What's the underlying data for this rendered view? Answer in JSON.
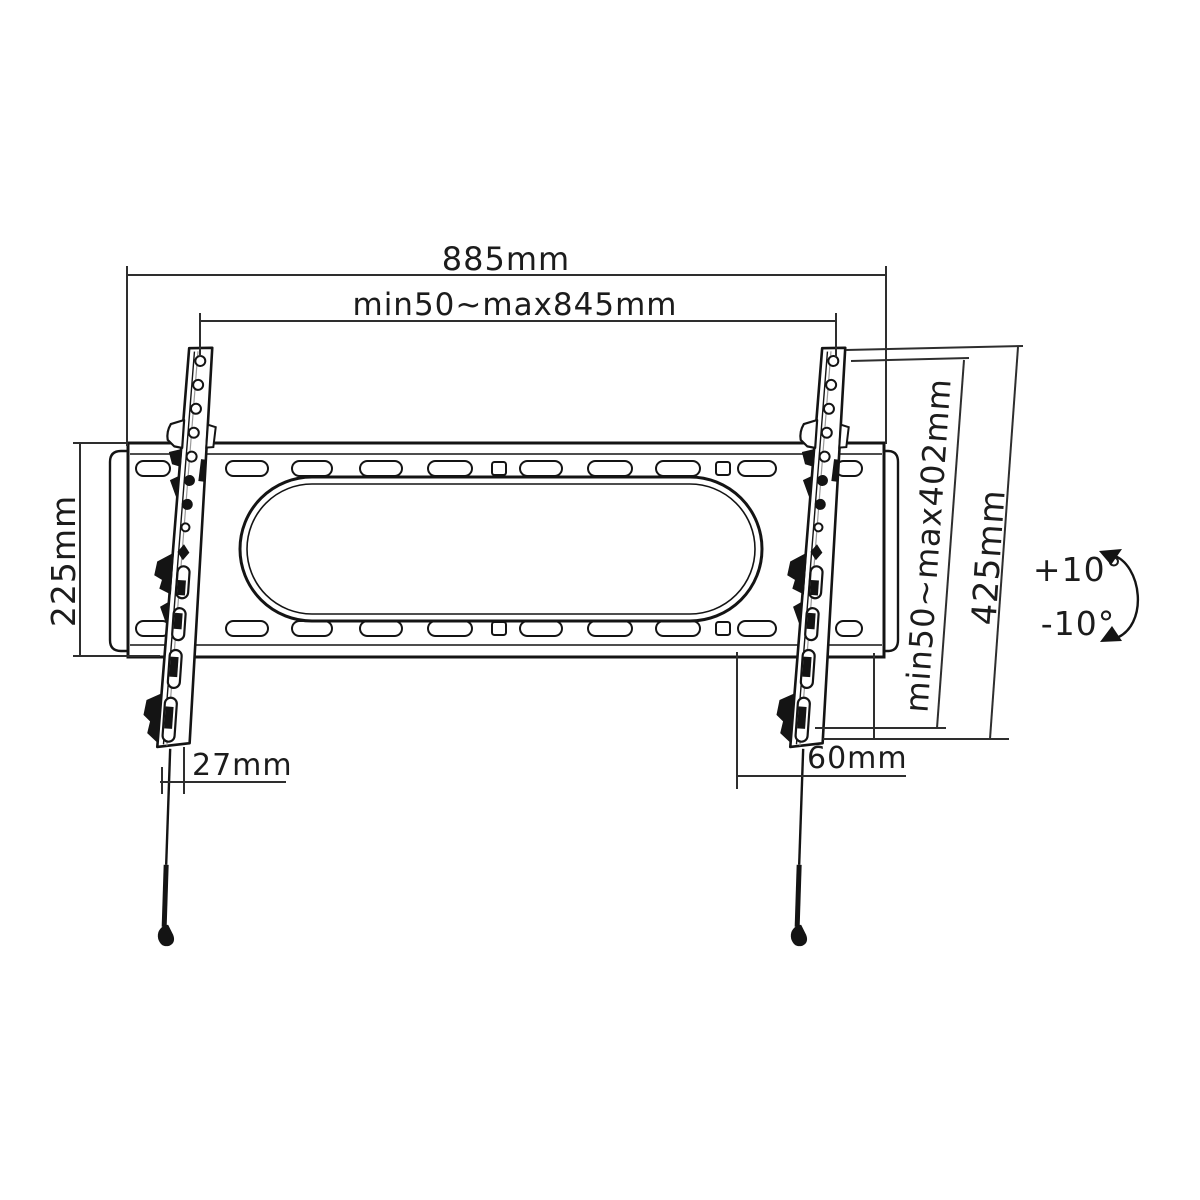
{
  "diagram": {
    "colors": {
      "background": "#ffffff",
      "line": "#141414",
      "thin_line": "#2e2e2e"
    },
    "labels": {
      "width_total": "885mm",
      "width_range": "min50~max845mm",
      "height_left": "225mm",
      "height_range": "min50~max402mm",
      "height_total": "425mm",
      "offset_bottom_left": "27mm",
      "offset_bottom_right": "60mm",
      "tilt_up": "+10°",
      "tilt_down": "-10°"
    }
  }
}
